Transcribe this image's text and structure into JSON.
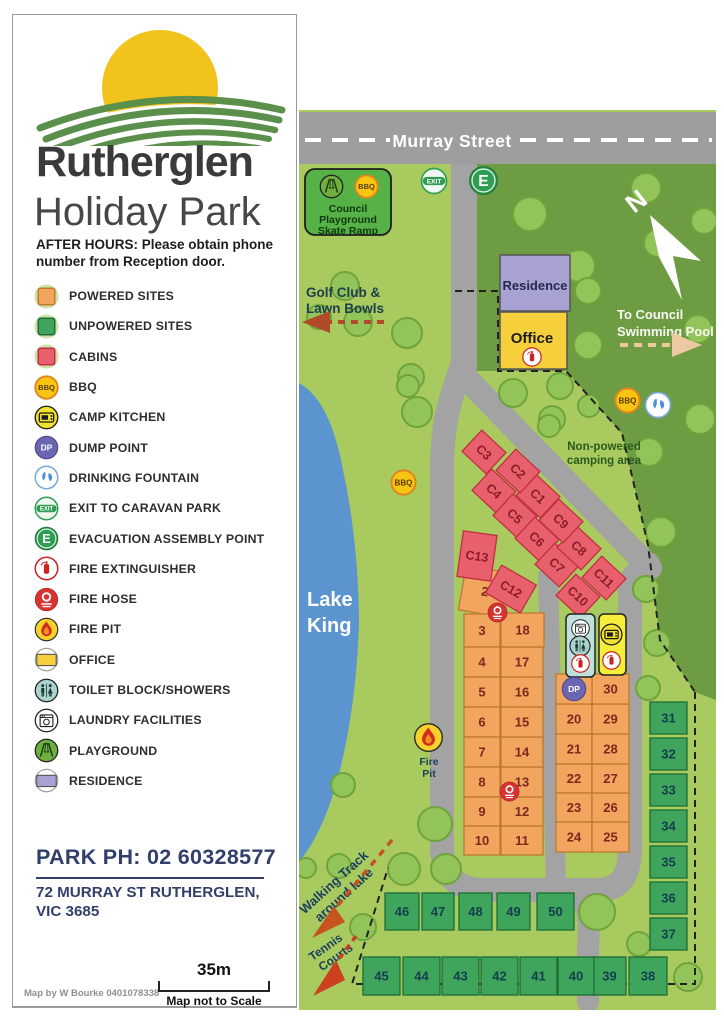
{
  "header": {
    "title1": "Rutherglen",
    "title2": "Holiday Park",
    "after_hours1": "AFTER HOURS: Please obtain phone",
    "after_hours2": "number from Reception door."
  },
  "legend": {
    "items": [
      {
        "icon": "square-powered",
        "label": "POWERED SITES"
      },
      {
        "icon": "square-unpowered",
        "label": "UNPOWERED SITES"
      },
      {
        "icon": "square-cabin",
        "label": "CABINS"
      },
      {
        "icon": "bbq",
        "label": "BBQ"
      },
      {
        "icon": "kitchen",
        "label": "CAMP KITCHEN"
      },
      {
        "icon": "dp",
        "label": "DUMP POINT"
      },
      {
        "icon": "fountain",
        "label": "DRINKING FOUNTAIN"
      },
      {
        "icon": "exit",
        "label": "EXIT TO CARAVAN PARK"
      },
      {
        "icon": "evac",
        "label": "EVACUATION ASSEMBLY POINT"
      },
      {
        "icon": "ext",
        "label": "FIRE EXTINGUISHER"
      },
      {
        "icon": "hose",
        "label": "FIRE HOSE"
      },
      {
        "icon": "firepit",
        "label": "FIRE PIT"
      },
      {
        "icon": "office",
        "label": "OFFICE"
      },
      {
        "icon": "toilet",
        "label": "TOILET BLOCK/SHOWERS"
      },
      {
        "icon": "laundry",
        "label": "LAUNDRY FACILITIES"
      },
      {
        "icon": "playground",
        "label": "PLAYGROUND"
      },
      {
        "icon": "residence",
        "label": "RESIDENCE"
      }
    ]
  },
  "contact": {
    "phone": "PARK PH: 02 60328577",
    "address1": "72 MURRAY ST RUTHERGLEN,",
    "address2": "VIC 3685"
  },
  "footer": {
    "credit": "Map by W Bourke 0401078338",
    "scale": "35m",
    "scale_note": "Map not to Scale"
  },
  "map": {
    "street": "Murray Street",
    "labels": {
      "council_l1": "Council",
      "council_l2": "Playground",
      "council_l3": "Skate Ramp",
      "golf_l1": "Golf Club &",
      "golf_l2": "Lawn Bowls",
      "pool_l1": "To Council",
      "pool_l2": "Swimming Pool",
      "residence": "Residence",
      "office": "Office",
      "nonpowered_l1": "Non-powered",
      "nonpowered_l2": "camping area",
      "lake_l1": "Lake",
      "lake_l2": "King",
      "firepit_l1": "Fire",
      "firepit_l2": "Pit",
      "walking_l1": "Walking Track",
      "walking_l2": "around lake",
      "tennis_l1": "Tennis",
      "tennis_l2": "Courts",
      "north": "N",
      "exit_badge": "EXIT",
      "evac_badge": "E",
      "bbq_badge": "BBQ",
      "dp_badge": "DP"
    },
    "cabins": [
      "C1",
      "C2",
      "C3",
      "C4",
      "C5",
      "C6",
      "C7",
      "C8",
      "C9",
      "C10",
      "C11",
      "C12",
      "C13"
    ],
    "powered_sites": [
      "2",
      "3",
      "4",
      "5",
      "6",
      "7",
      "8",
      "9",
      "10",
      "11",
      "12",
      "13",
      "14",
      "15",
      "16",
      "17",
      "18",
      "20",
      "21",
      "22",
      "23",
      "24",
      "25",
      "26",
      "27",
      "28",
      "29",
      "30"
    ],
    "unpowered_sites": [
      "31",
      "32",
      "33",
      "34",
      "35",
      "36",
      "37",
      "38",
      "39",
      "40",
      "41",
      "42",
      "43",
      "44",
      "45",
      "46",
      "47",
      "48",
      "49",
      "50"
    ]
  },
  "colors": {
    "powered": "#F2A55E",
    "powered_border": "#BE7A2E",
    "powered_text": "#7A2A1D",
    "unpowered": "#3FA45C",
    "unpowered_border": "#1C6E33",
    "unpowered_text": "#123F4D",
    "cabin": "#E85F6D",
    "cabin_border": "#C12F40",
    "cabin_text": "#8C1D28",
    "lake": "#5B94CE",
    "road": "#A3A3A3",
    "park_light": "#A8CA5E",
    "park_dark": "#6E9C42",
    "office": "#F6CF3D",
    "residence": "#A8A2D3",
    "navy": "#323F6B"
  }
}
